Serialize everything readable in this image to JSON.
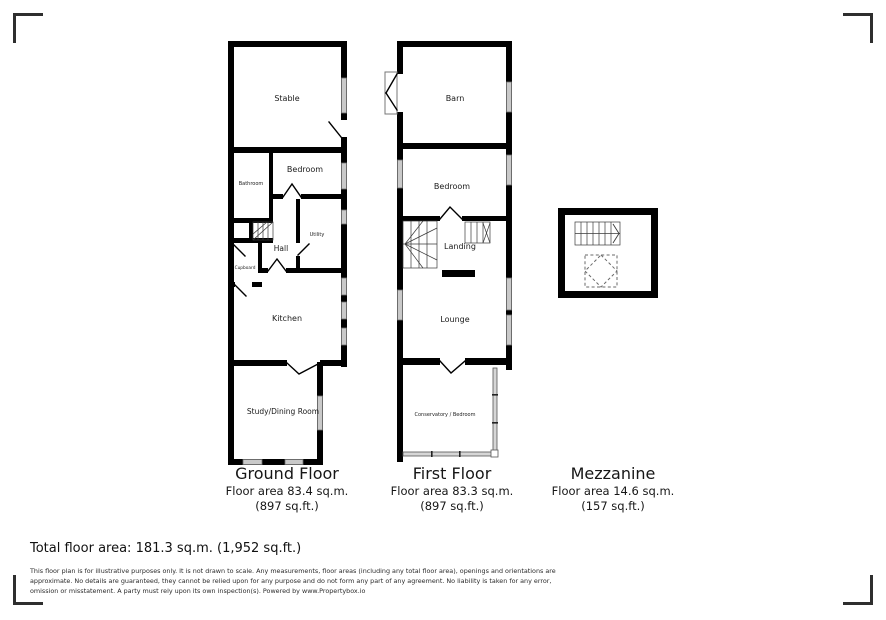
{
  "colors": {
    "wall": "#000000",
    "window": "#c9c9c9",
    "glazing": "#d6d6d6",
    "text": "#1a1a1a"
  },
  "plans": {
    "ground": {
      "title": "Ground Floor",
      "area_line1": "Floor area 83.4 sq.m.",
      "area_line2": "(897 sq.ft.)",
      "rooms": {
        "stable": "Stable",
        "bathroom": "Bathroom",
        "bedroom": "Bedroom",
        "utility": "Utility",
        "hall": "Hall",
        "cupboard": "Cupboard",
        "kitchen": "Kitchen",
        "study": "Study/Dining Room"
      }
    },
    "first": {
      "title": "First Floor",
      "area_line1": "Floor area 83.3 sq.m.",
      "area_line2": "(897 sq.ft.)",
      "rooms": {
        "barn": "Barn",
        "bedroom": "Bedroom",
        "landing": "Landing",
        "lounge": "Lounge",
        "conservatory": "Conservatory / Bedroom"
      }
    },
    "mezzanine": {
      "title": "Mezzanine",
      "area_line1": "Floor area 14.6 sq.m.",
      "area_line2": "(157 sq.ft.)"
    }
  },
  "summary": {
    "total": "Total floor area: 181.3 sq.m. (1,952 sq.ft.)"
  },
  "disclaimer": {
    "line1": "This floor plan is for illustrative purposes only. It is not drawn to scale. Any measurements, floor areas (including any total floor area), openings and orientations are",
    "line2": "approximate. No details are guaranteed, they cannot be relied upon for any purpose and do not form any part of any agreement. No liability is taken for any error,",
    "line3": "omission or misstatement. A party must rely upon its own inspection(s). Powered by www.Propertybox.io"
  }
}
